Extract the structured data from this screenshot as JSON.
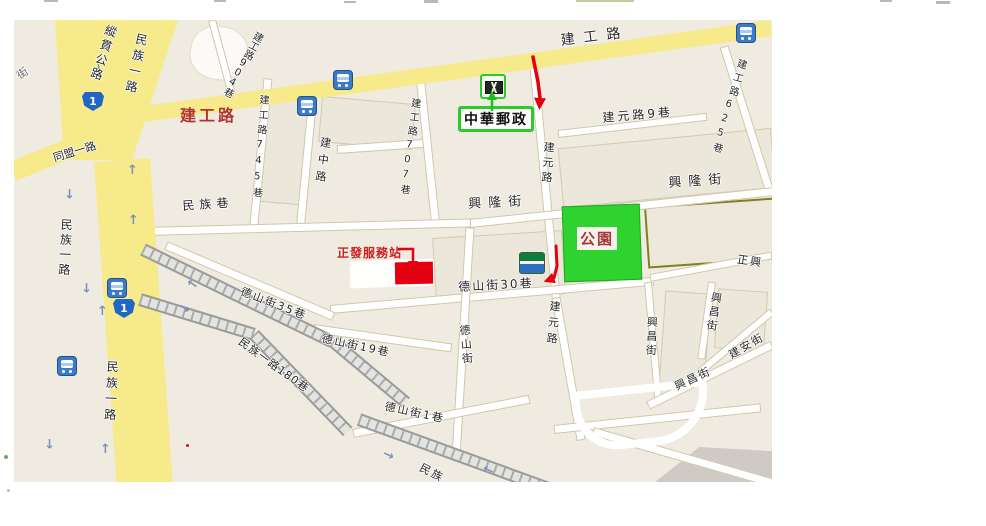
{
  "map": {
    "background": "#EFEBE0",
    "colors": {
      "major_road": "#F7EA8A",
      "minor_road": "#FFFFFF",
      "park_green": "#2FD32F",
      "annotation_red": "#E30010",
      "annotation_green": "#2BCB2B",
      "olive_border": "#7F801F"
    },
    "traffic_glyph": "↑",
    "road_labels": [
      {
        "text": "建工路",
        "x": 546,
        "y": 14,
        "rot": -7,
        "mode": "h",
        "size": 14,
        "ls": 9
      },
      {
        "text": "縱貫公路",
        "x": 92,
        "y": 3,
        "rot": 18,
        "mode": "v",
        "size": 12,
        "ls": 3
      },
      {
        "text": "民族一路",
        "x": 122,
        "y": 12,
        "rot": 12,
        "mode": "v",
        "size": 12,
        "ls": 4
      },
      {
        "text": "民族一路",
        "x": 46,
        "y": 198,
        "rot": 3,
        "mode": "v",
        "size": 12,
        "ls": 3
      },
      {
        "text": "民族一路",
        "x": 92,
        "y": 340,
        "rot": 3,
        "mode": "v",
        "size": 12,
        "ls": 4
      },
      {
        "text": "同盟一路",
        "x": 38,
        "y": 133,
        "rot": -17,
        "mode": "h",
        "size": 11,
        "ls": 0
      },
      {
        "text": "街",
        "x": 1,
        "y": 52,
        "rot": -35,
        "mode": "h",
        "size": 11,
        "ls": 0,
        "color": "#666666"
      },
      {
        "text": "建工路904巷",
        "x": 240,
        "y": 9,
        "rot": 28,
        "mode": "v",
        "size": 10,
        "ls": 0
      },
      {
        "text": "建工路745巷",
        "x": 243,
        "y": 74,
        "rot": 4,
        "mode": "v",
        "size": 10,
        "ls": 5
      },
      {
        "text": "建中路",
        "x": 306,
        "y": 116,
        "rot": 8,
        "mode": "v",
        "size": 11,
        "ls": 6
      },
      {
        "text": "建工路707巷",
        "x": 395,
        "y": 77,
        "rot": 7,
        "mode": "v",
        "size": 10,
        "ls": 4
      },
      {
        "text": "建元路",
        "x": 529,
        "y": 121,
        "rot": 4,
        "mode": "v",
        "size": 11,
        "ls": 4
      },
      {
        "text": "建元路9巷",
        "x": 588,
        "y": 92,
        "rot": -5,
        "mode": "h",
        "size": 12,
        "ls": 3
      },
      {
        "text": "建工路625巷",
        "x": 722,
        "y": 37,
        "rot": 16,
        "mode": "v",
        "size": 10,
        "ls": 4
      },
      {
        "text": "興隆街",
        "x": 454,
        "y": 178,
        "rot": -3,
        "mode": "h",
        "size": 13,
        "ls": 7
      },
      {
        "text": "興隆街",
        "x": 654,
        "y": 157,
        "rot": -4,
        "mode": "h",
        "size": 13,
        "ls": 7
      },
      {
        "text": "民族巷",
        "x": 168,
        "y": 180,
        "rot": -4,
        "mode": "h",
        "size": 12,
        "ls": 5
      },
      {
        "text": "德山街35巷",
        "x": 229,
        "y": 266,
        "rot": 21,
        "mode": "h",
        "size": 11,
        "ls": 2
      },
      {
        "text": "德山街19巷",
        "x": 309,
        "y": 313,
        "rot": 12,
        "mode": "h",
        "size": 11,
        "ls": 2
      },
      {
        "text": "德山街30巷",
        "x": 444,
        "y": 261,
        "rot": -3,
        "mode": "h",
        "size": 12,
        "ls": 2
      },
      {
        "text": "德山街",
        "x": 444,
        "y": 305,
        "rot": -5,
        "mode": "v",
        "size": 11,
        "ls": 3
      },
      {
        "text": "德山街1巷",
        "x": 372,
        "y": 381,
        "rot": 12,
        "mode": "h",
        "size": 11,
        "ls": 2
      },
      {
        "text": "民族一路180巷",
        "x": 229,
        "y": 316,
        "rot": 36,
        "mode": "h",
        "size": 11,
        "ls": 1
      },
      {
        "text": "民族",
        "x": 409,
        "y": 442,
        "rot": 28,
        "mode": "h",
        "size": 11,
        "ls": 2
      },
      {
        "text": "建元路",
        "x": 535,
        "y": 280,
        "rot": 5,
        "mode": "v",
        "size": 11,
        "ls": 5
      },
      {
        "text": "興昌街",
        "x": 632,
        "y": 296,
        "rot": 2,
        "mode": "v",
        "size": 11,
        "ls": 3
      },
      {
        "text": "興昌街",
        "x": 697,
        "y": 271,
        "rot": 9,
        "mode": "v",
        "size": 11,
        "ls": 3
      },
      {
        "text": "興昌街",
        "x": 659,
        "y": 362,
        "rot": -25,
        "mode": "h",
        "size": 11,
        "ls": 2
      },
      {
        "text": "建安街",
        "x": 713,
        "y": 331,
        "rot": -30,
        "mode": "h",
        "size": 11,
        "ls": 2
      },
      {
        "text": "正興",
        "x": 724,
        "y": 234,
        "rot": 8,
        "mode": "h",
        "size": 11,
        "ls": 2
      }
    ],
    "icons": [
      {
        "type": "bus",
        "x": 319,
        "y": 50
      },
      {
        "type": "bus",
        "x": 283,
        "y": 76
      },
      {
        "type": "bus",
        "x": 722,
        "y": 3
      },
      {
        "type": "bus",
        "x": 93,
        "y": 258
      },
      {
        "type": "bus",
        "x": 43,
        "y": 336
      },
      {
        "type": "highway",
        "x": 68,
        "y": 72,
        "label": "1"
      },
      {
        "type": "highway",
        "x": 99,
        "y": 279,
        "label": "1"
      },
      {
        "type": "post",
        "x": 466,
        "y": 54
      },
      {
        "type": "store",
        "x": 505,
        "y": 232
      }
    ],
    "traffic_arrows": [
      {
        "x": 79,
        "y": 40,
        "rot": 180
      },
      {
        "x": 50,
        "y": 166,
        "rot": 180
      },
      {
        "x": 113,
        "y": 144,
        "rot": 0
      },
      {
        "x": 114,
        "y": 194,
        "rot": 0
      },
      {
        "x": 67,
        "y": 260,
        "rot": 180
      },
      {
        "x": 83,
        "y": 285,
        "rot": 0
      },
      {
        "x": 30,
        "y": 416,
        "rot": 180
      },
      {
        "x": 86,
        "y": 423,
        "rot": 0
      },
      {
        "x": 174,
        "y": 258,
        "rot": -57
      },
      {
        "x": 164,
        "y": 281,
        "rot": 123
      },
      {
        "x": 368,
        "y": 428,
        "rot": 115
      },
      {
        "x": 470,
        "y": 444,
        "rot": -65
      }
    ],
    "annotations": {
      "post_label": {
        "text": "中華郵政"
      },
      "service_label": {
        "text": "正發服務站"
      },
      "park_label": {
        "text": "公園"
      },
      "jiangong_label": {
        "text": "建工路"
      },
      "marker_rect": {
        "x": 381,
        "y": 242,
        "w": 38,
        "h": 22,
        "color": "#E30010"
      },
      "arrows": [
        {
          "name": "red-arrow-post",
          "pts": [
            [
              519,
              37
            ],
            [
              524,
              62
            ],
            [
              526,
              78
            ]
          ],
          "angle": 93,
          "w": 3.5,
          "color": "#E30010",
          "hl": 12,
          "hw": 6
        },
        {
          "name": "red-arrow-store",
          "pts": [
            [
              542,
              226
            ],
            [
              543,
              246
            ],
            [
              540,
              258
            ]
          ],
          "angle": 160,
          "w": 3,
          "color": "#E30010",
          "hl": 11,
          "hw": 5.5
        },
        {
          "name": "red-arrow-elbow",
          "pts": [
            [
              385,
              229
            ],
            [
              399,
              229
            ],
            [
              399,
              241
            ]
          ],
          "angle": 90,
          "w": 2.5,
          "color": "#E30010",
          "hl": 10,
          "hw": 5
        },
        {
          "name": "green-arrow-up",
          "pts": [
            [
              478,
              90
            ],
            [
              478,
              80
            ]
          ],
          "angle": -90,
          "w": 2.5,
          "color": "#1FBE1F",
          "hl": 9,
          "hw": 5
        }
      ]
    },
    "edge_marks": [
      {
        "x": 44,
        "y": 0,
        "w": 14,
        "h": 2,
        "color": "#B9B9B9"
      },
      {
        "x": 214,
        "y": 0,
        "w": 12,
        "h": 2,
        "color": "#B9B9B9"
      },
      {
        "x": 344,
        "y": 1,
        "w": 12,
        "h": 2,
        "color": "#B9B9B9"
      },
      {
        "x": 424,
        "y": 0,
        "w": 14,
        "h": 3,
        "color": "#B9B9B9"
      },
      {
        "x": 576,
        "y": 0,
        "w": 58,
        "h": 2,
        "color": "#C8C89E"
      },
      {
        "x": 880,
        "y": 0,
        "w": 12,
        "h": 2,
        "color": "#B9B9B9"
      },
      {
        "x": 936,
        "y": 1,
        "w": 14,
        "h": 3,
        "color": "#B9B9B9"
      }
    ],
    "dots": [
      {
        "x": 4,
        "y": 455,
        "s": 4,
        "color": "#6FA66F"
      },
      {
        "x": 7,
        "y": 489,
        "s": 3,
        "color": "#B9B9B9"
      },
      {
        "x": 186,
        "y": 444,
        "s": 3,
        "color": "#CC1515"
      }
    ]
  }
}
